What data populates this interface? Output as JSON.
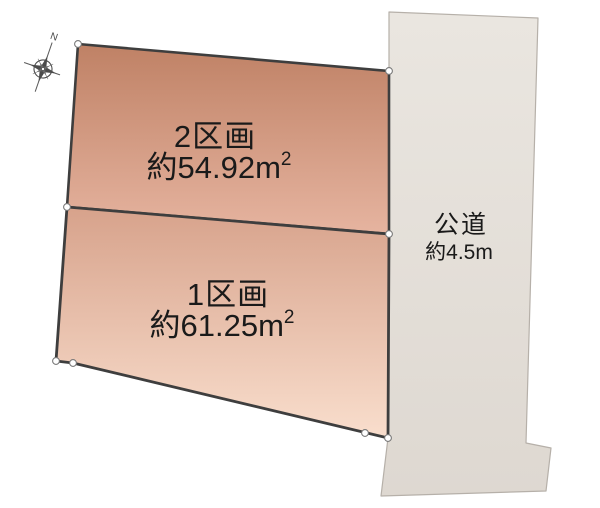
{
  "diagram": {
    "type": "land-parcel-plan",
    "background_color": "#ffffff",
    "outline_color": "#3e3e3e",
    "marker_color": "#ffffff",
    "compass": {
      "north_label": "N",
      "rotation_deg": 19,
      "color": "#4b4b4b"
    },
    "parcels": [
      {
        "id": "section-2",
        "name": "2区画",
        "area_value": "約54.92",
        "area_unit": "m",
        "area_exponent": "2",
        "fill_top": "#bf8165",
        "fill_bottom": "#e6b4a0"
      },
      {
        "id": "section-1",
        "name": "1区画",
        "area_value": "約61.25",
        "area_unit": "m",
        "area_exponent": "2",
        "fill_top": "#d7a28b",
        "fill_bottom": "#f9decd"
      }
    ],
    "road": {
      "name": "公道",
      "width_label": "約4.5m",
      "fill_top": "#eae6e0",
      "fill_bottom": "#ded8d1",
      "edge_color": "#b6b0a9"
    }
  }
}
